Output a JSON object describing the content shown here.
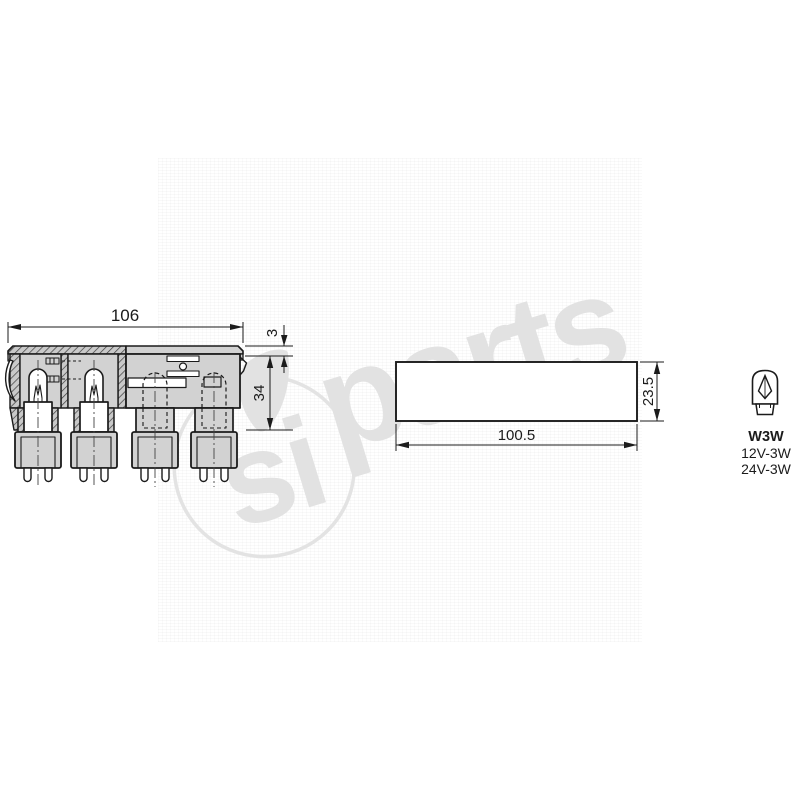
{
  "colors": {
    "background": "#ffffff",
    "line": "#1b1b1b",
    "part_fill": "#d2d2d2",
    "watermark": "#e2e2e2"
  },
  "dimensions": {
    "module_width": "106",
    "flange_thickness": "3",
    "module_height": "34",
    "panel_width": "100.5",
    "panel_height": "23.5"
  },
  "bulb_info": {
    "type": "W3W",
    "spec_12v": "12V-3W",
    "spec_24v": "24V-3W"
  },
  "watermark": {
    "logo_text": "si",
    "brand_text": "parts"
  }
}
